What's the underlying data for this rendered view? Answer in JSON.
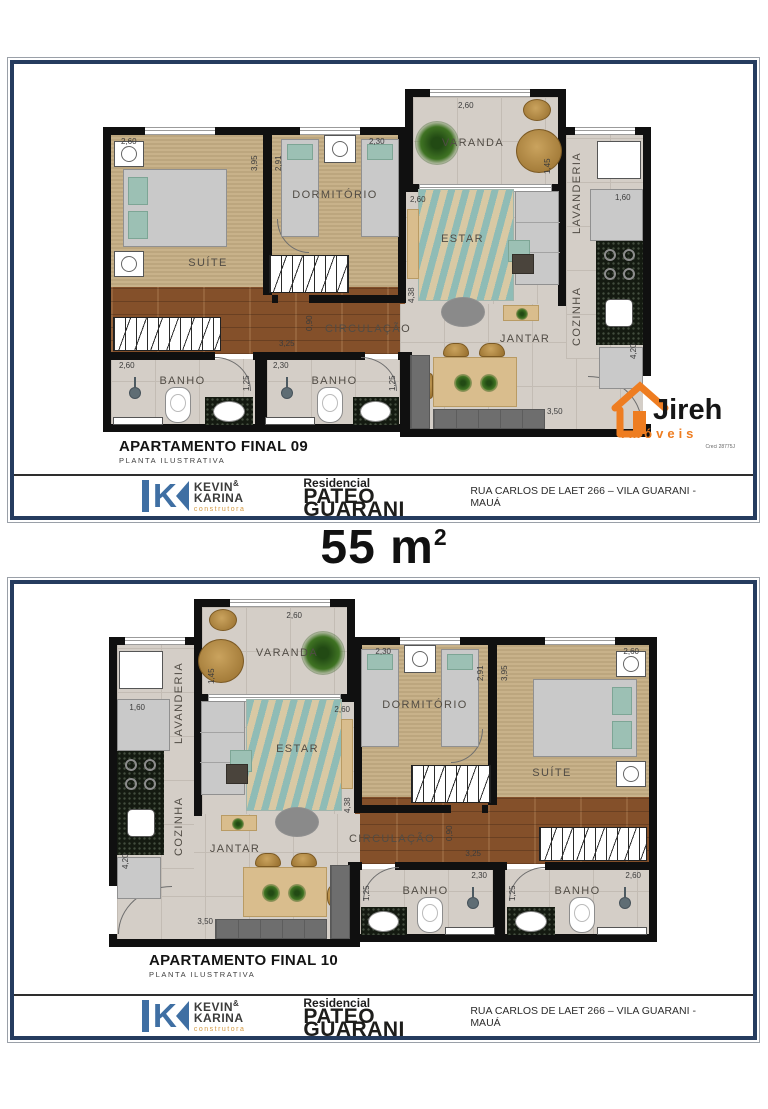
{
  "page": {
    "area_value": "55",
    "area_unit": "m",
    "area_sup": "2"
  },
  "plan": {
    "rooms": {
      "suite": "SUÍTE",
      "dormitorio": "DORMITÓRIO",
      "varanda": "VARANDA",
      "estar": "ESTAR",
      "lavanderia": "LAVANDERIA",
      "cozinha": "COZINHA",
      "circulacao": "CIRCULAÇÃO",
      "jantar": "JANTAR",
      "banho1": "BANHO",
      "banho2": "BANHO"
    },
    "dims": {
      "suite_w": "2,60",
      "suite_h": "3,95",
      "dorm_h": "2,91",
      "dorm_w": "2,30",
      "varanda_w": "2,60",
      "varanda_h": "1,45",
      "estar_w": "2,60",
      "estar_h": "4,38",
      "circ_h": "0,90",
      "hall_w": "3,25",
      "banho1_w": "2,60",
      "banho1_h": "1,25",
      "banho2_w": "2,30",
      "banho2_h": "1,25",
      "jantar_w": "3,50",
      "lav_w": "1,60",
      "coz_h": "4,20"
    }
  },
  "frames": [
    {
      "caption": "APARTAMENTO FINAL 09",
      "subcaption": "PLANTA ILUSTRATIVA"
    },
    {
      "caption": "APARTAMENTO FINAL 10",
      "subcaption": "PLANTA ILUSTRATIVA"
    }
  ],
  "footer": {
    "builder": {
      "line1": "KEVIN",
      "amp": "&",
      "line2": "KARINA",
      "sub": "construtora",
      "blue": "#3f6fa3"
    },
    "residencial": "Residencial",
    "project": "PATEO GUARANI",
    "address": "RUA CARLOS DE LAET 266 – VILA GUARANI - MAUÁ"
  },
  "agency": {
    "name": "Jireh",
    "sub": "imóveis",
    "creci": "Creci 28775J",
    "orange": "#ee7d21"
  }
}
